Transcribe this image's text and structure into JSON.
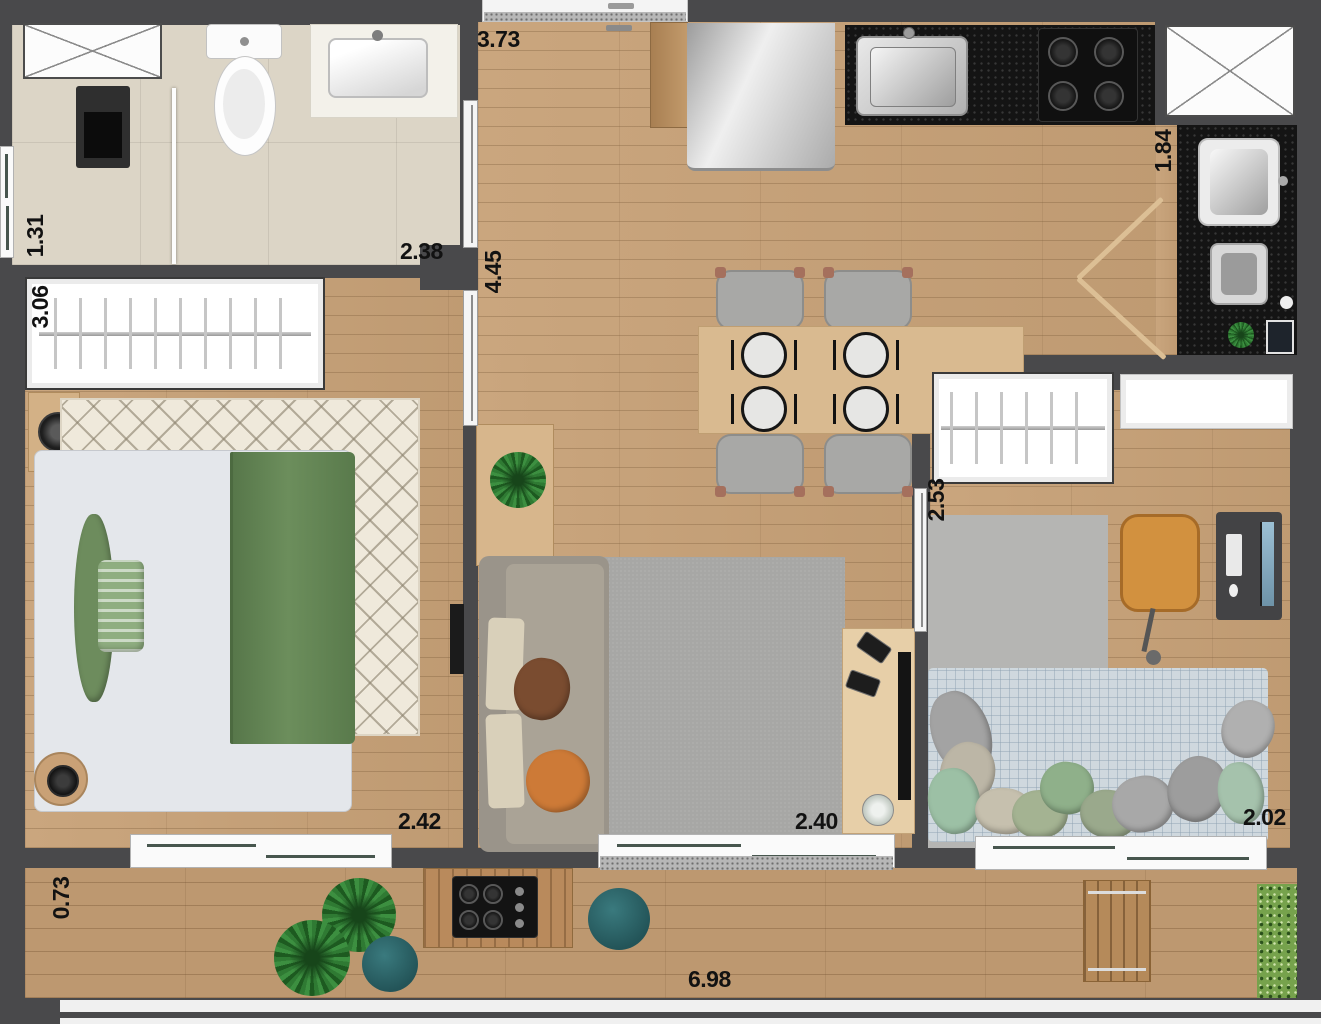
{
  "title": "apartment-floor-plan",
  "dimensions": {
    "entry": "3.73",
    "bath": "2.38",
    "hall": "4.45",
    "bath_depth": "1.31",
    "bedroom1_length": "3.06",
    "service": "1.84",
    "bedroom2_length": "2.53",
    "bedroom1_width": "2.42",
    "living_width": "2.40",
    "bedroom2_width": "2.02",
    "balcony_depth": "0.73",
    "balcony_width": "6.98"
  },
  "colors": {
    "wall": "#49494b",
    "wood_floor": "#c7a177",
    "balcony_floor": "#bd9870",
    "bath_tile": "#dcd5c6",
    "counter_granite": "#141414",
    "rug_cream": "#efe9db",
    "rug_gray": "#a7a7a5",
    "bedding_green": "#5e7f50",
    "bed2_plaid": "#cfd8de",
    "pouf_teal": "#2c686d",
    "chair_orange": "#d2913f",
    "sofa_taupe": "#9a948a",
    "table_wood": "#d9ba90"
  }
}
